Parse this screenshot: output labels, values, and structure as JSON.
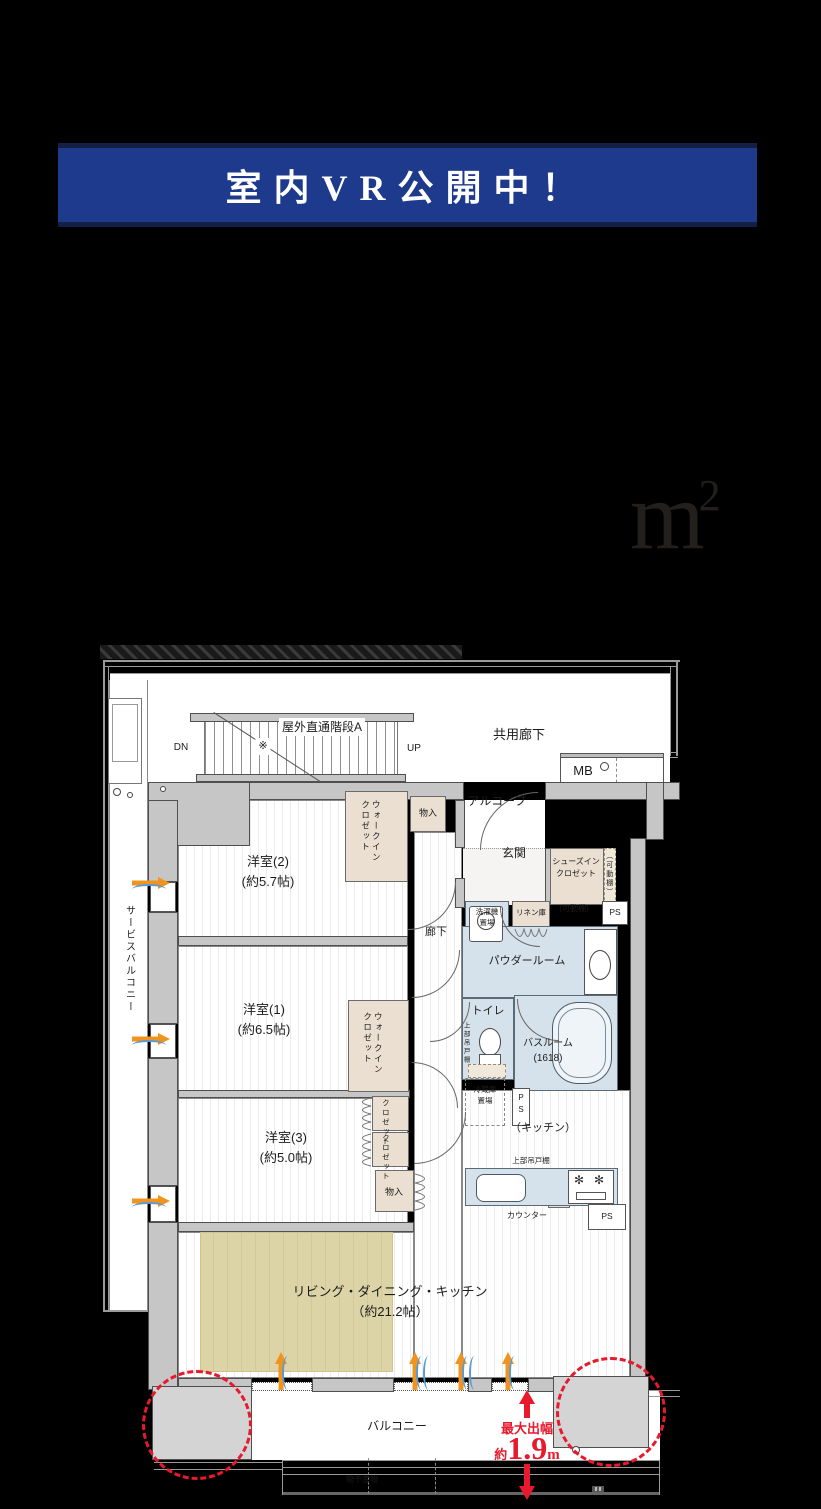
{
  "banner": {
    "text": "室内VR公開中！",
    "bg": "#1d3a8c",
    "frame": "#131f45",
    "text_color": "#ffffff"
  },
  "area_display": {
    "unit_base": "m",
    "unit_exponent": "2"
  },
  "colors": {
    "page_bg": "#000000",
    "wall": "#c6c6c6",
    "closet": "#eadfd0",
    "water": "#d6e2eb",
    "rug": "#dcd4a6",
    "accent_red": "#e8192c",
    "vent_orange": "#f0941e",
    "wave_blue": "#5b9bd5"
  },
  "floorplan": {
    "annotation": {
      "label": "最大出幅",
      "prefix": "約",
      "value": "1.9",
      "unit": "m",
      "color": "#e8192c"
    },
    "labels": [
      {
        "name": "stairs-label",
        "text": "屋外直通階段A",
        "x": 322,
        "y": 718,
        "fs": 12,
        "bg": 1
      },
      {
        "name": "stairs-mark",
        "text": "※",
        "x": 263,
        "y": 738,
        "fs": 11,
        "bg": 1
      },
      {
        "name": "dn-label",
        "text": "DN",
        "x": 181,
        "y": 740,
        "fs": 10
      },
      {
        "name": "up-label",
        "text": "UP",
        "x": 414,
        "y": 741,
        "fs": 10
      },
      {
        "name": "common-corridor-label",
        "text": "共用廊下",
        "x": 519,
        "y": 725,
        "fs": 13
      },
      {
        "name": "mb-label",
        "text": "MB",
        "x": 583,
        "y": 761,
        "fs": 13
      },
      {
        "name": "alcove-label",
        "text": "アルコーブ",
        "x": 497,
        "y": 792,
        "fs": 12
      },
      {
        "name": "storage-top-label",
        "text": "物入",
        "x": 428,
        "y": 807,
        "fs": 9
      },
      {
        "name": "wic2-label",
        "text": "ウォークイン\nクロゼット",
        "x": 360,
        "y": 800,
        "fs": 8.5,
        "v": 1,
        "h": 80
      },
      {
        "name": "bedroom2-label",
        "text": "洋室(2)\n(約5.7帖)",
        "x": 268,
        "y": 852,
        "fs": 13
      },
      {
        "name": "entrance-label",
        "text": "玄関",
        "x": 514,
        "y": 844,
        "fs": 12
      },
      {
        "name": "shoes-closet-label",
        "text": "シューズイン\nクロゼット",
        "x": 576,
        "y": 856,
        "fs": 8
      },
      {
        "name": "shelf-v-label",
        "text": "（可動棚）",
        "x": 604,
        "y": 852,
        "fs": 7,
        "v": 1,
        "h": 52
      },
      {
        "name": "shelf-h-label",
        "text": "(可動棚)",
        "x": 574,
        "y": 903,
        "fs": 8
      },
      {
        "name": "ps1-label",
        "text": "PS",
        "x": 615,
        "y": 906,
        "fs": 8.5
      },
      {
        "name": "laundry-label",
        "text": "洗濯機\n置場",
        "x": 487,
        "y": 906,
        "fs": 7.5
      },
      {
        "name": "linen-label",
        "text": "リネン庫",
        "x": 531,
        "y": 907,
        "fs": 7.5
      },
      {
        "name": "corridor-label",
        "text": "廊下",
        "x": 436,
        "y": 924,
        "fs": 11
      },
      {
        "name": "powder-room-label",
        "text": "パウダールーム",
        "x": 527,
        "y": 953,
        "fs": 11
      },
      {
        "name": "toilet-label",
        "text": "トイレ",
        "x": 488,
        "y": 1003,
        "fs": 11
      },
      {
        "name": "upper-cabinet-v-label",
        "text": "上部吊戸棚",
        "x": 461,
        "y": 1022,
        "fs": 6.5,
        "v": 1,
        "h": 46
      },
      {
        "name": "bathroom-label",
        "text": "バスルーム\n(1618)",
        "x": 548,
        "y": 1036,
        "fs": 10
      },
      {
        "name": "fridge-label",
        "text": "冷蔵庫\n置場",
        "x": 485,
        "y": 1084,
        "fs": 7.5
      },
      {
        "name": "ps2-label",
        "text": "P\nS",
        "x": 521,
        "y": 1092,
        "fs": 8
      },
      {
        "name": "kitchen-label",
        "text": "（キッチン）",
        "x": 543,
        "y": 1120,
        "fs": 11
      },
      {
        "name": "upper-cabinet-h-label",
        "text": "上部吊戸棚",
        "x": 531,
        "y": 1155,
        "fs": 7.5
      },
      {
        "name": "counter-label",
        "text": "カウンター",
        "x": 527,
        "y": 1210,
        "fs": 8
      },
      {
        "name": "ps3-label",
        "text": "PS",
        "x": 607,
        "y": 1210,
        "fs": 8.5
      },
      {
        "name": "bedroom1-label",
        "text": "洋室(1)\n(約6.5帖)",
        "x": 264,
        "y": 1000,
        "fs": 13
      },
      {
        "name": "wic1-label",
        "text": "ウォークイン\nクロゼット",
        "x": 362,
        "y": 1012,
        "fs": 8.5,
        "v": 1,
        "h": 80
      },
      {
        "name": "closet1-label",
        "text": "クロゼット",
        "x": 381,
        "y": 1099,
        "fs": 7.5,
        "v": 1,
        "h": 33
      },
      {
        "name": "closet2-label",
        "text": "クロゼット",
        "x": 381,
        "y": 1134,
        "fs": 7.5,
        "v": 1,
        "h": 33
      },
      {
        "name": "storage3-label",
        "text": "物入",
        "x": 394,
        "y": 1186,
        "fs": 9
      },
      {
        "name": "bedroom3-label",
        "text": "洋室(3)\n(約5.0帖)",
        "x": 286,
        "y": 1128,
        "fs": 13
      },
      {
        "name": "ldk-label",
        "text": "リビング・ダイニング・キッチン\n（約21.2帖）",
        "x": 390,
        "y": 1282,
        "fs": 13
      },
      {
        "name": "balcony-label",
        "text": "バルコニー",
        "x": 397,
        "y": 1417,
        "fs": 12
      },
      {
        "name": "drying-fitting-label",
        "text": "物干金物",
        "x": 362,
        "y": 1474,
        "fs": 8
      },
      {
        "name": "service-balcony-label",
        "text": "サービスバルコニー",
        "x": 122,
        "y": 905,
        "fs": 10,
        "v": 1,
        "h": 155
      }
    ]
  }
}
